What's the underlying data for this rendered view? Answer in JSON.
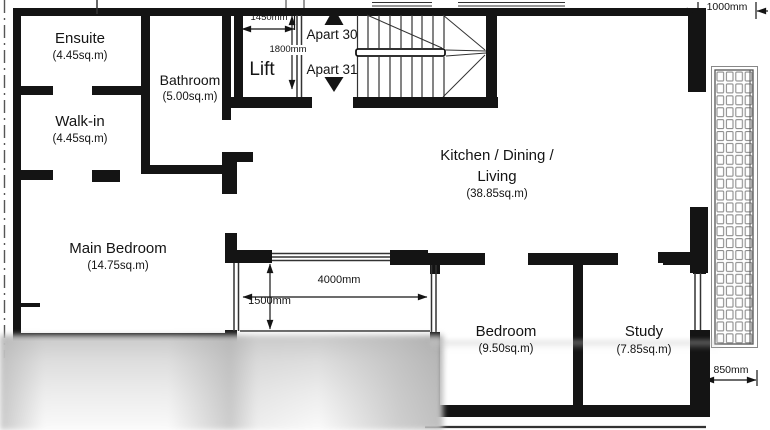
{
  "plan": {
    "rooms": {
      "ensuite": {
        "name": "Ensuite",
        "area": "(4.45sq.m)"
      },
      "bathroom": {
        "name": "Bathroom",
        "area": "(5.00sq.m)"
      },
      "walk_in": {
        "name": "Walk-in",
        "area": "(4.45sq.m)"
      },
      "main_bedroom": {
        "name": "Main Bedroom",
        "area": "(14.75sq.m)"
      },
      "kitchen": {
        "name_line1": "Kitchen / Dining /",
        "name_line2": "Living",
        "area": "(38.85sq.m)"
      },
      "bedroom": {
        "name": "Bedroom",
        "area": "(9.50sq.m)"
      },
      "study": {
        "name": "Study",
        "area": "(7.85sq.m)"
      },
      "lift": {
        "name": "Lift"
      }
    },
    "apartments": {
      "apart30": "Apart 30",
      "apart31": "Apart 31"
    },
    "dimensions": {
      "lift_width": "1450mm",
      "lift_depth": "1800mm",
      "terrace_width": "4000mm",
      "terrace_depth": "1500mm",
      "balcony_top_width": "1000mm",
      "balcony_right_width": "850mm"
    },
    "colors": {
      "wall": "#141414",
      "line": "#333333",
      "grid": "#8d8d8d"
    }
  }
}
